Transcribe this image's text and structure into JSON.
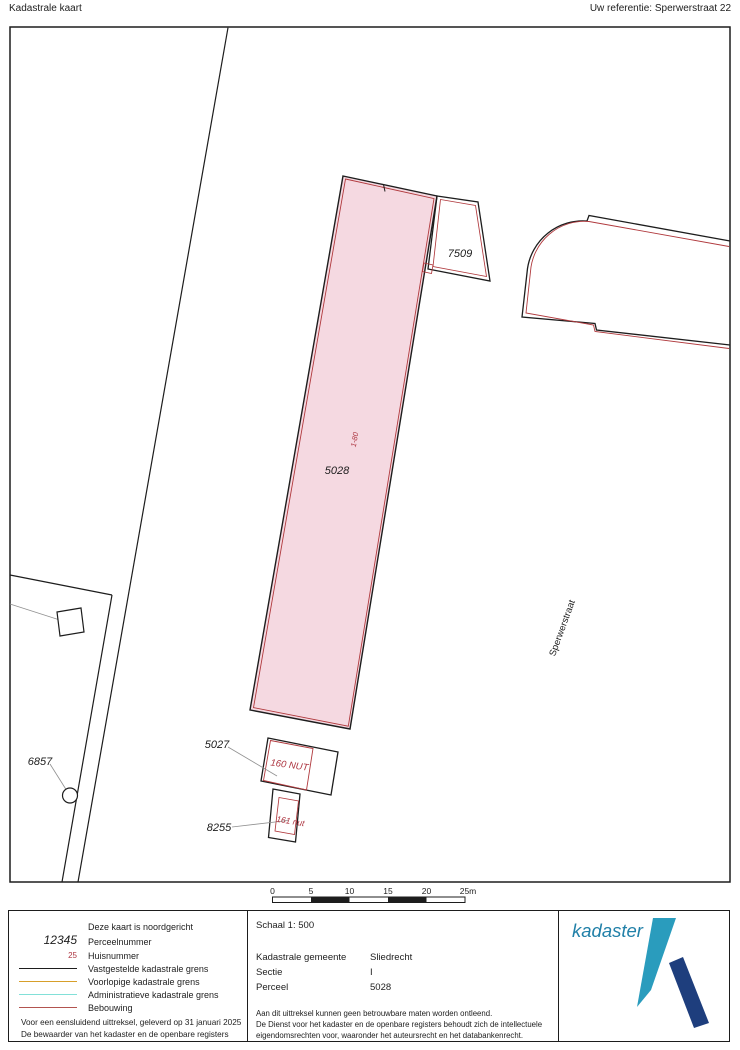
{
  "header": {
    "title": "Kadastrale kaart",
    "reference": "Uw referentie: Sperwerstraat 22"
  },
  "map": {
    "labels": {
      "parcel_7509": "7509",
      "parcel_5028": "5028",
      "parcel_5027": "5027",
      "parcel_8255": "8255",
      "parcel_6857": "6857",
      "house_range": "1-80",
      "house_160": "160 NUT",
      "house_161": "161 nut",
      "street": "Sperwerstraat"
    },
    "scalebar": {
      "ticks": [
        "0",
        "5",
        "10",
        "15",
        "20",
        "25m"
      ]
    }
  },
  "legend": {
    "north_note": "Deze kaart is noordgericht",
    "items": [
      {
        "symbol": "12345",
        "label": "Perceelnummer"
      },
      {
        "symbol": "25",
        "label": "Huisnummer"
      },
      {
        "label": "Vastgestelde kadastrale grens",
        "color": "#1d1d1d"
      },
      {
        "label": "Voorlopige kadastrale grens",
        "color": "#d79f2a"
      },
      {
        "label": "Administratieve kadastrale grens",
        "color": "#82e0d8"
      },
      {
        "label": "Bebouwing",
        "color": "#b2534f"
      }
    ],
    "footer_left": [
      "Voor een eensluidend uittreksel, geleverd op 31 januari 2025",
      "De bewaarder van het kadaster en de openbare registers"
    ],
    "scale_label": "Schaal 1: 500",
    "fields": [
      {
        "label": "Kadastrale gemeente",
        "value": "Sliedrecht"
      },
      {
        "label": "Sectie",
        "value": "I"
      },
      {
        "label": "Perceel",
        "value": "5028"
      }
    ],
    "footer_middle": [
      "Aan dit uittreksel kunnen geen betrouwbare maten worden ontleend.",
      "De Dienst voor het kadaster en de openbare registers behoudt zich de intellectuele",
      "eigendomsrechten voor, waaronder het auteursrecht en het databankenrecht."
    ],
    "logo_text": "kadaster"
  },
  "colors": {
    "parcel_highlight_fill": "#f5d9e1",
    "boundary_black": "#1d1d1d",
    "building_red": "#b0393d",
    "house_number_red": "#ad3540",
    "leader_gray": "#909090",
    "provisional_orange": "#d79f2a",
    "administrative_cyan": "#82e0d8",
    "legend_building_red": "#b2534f",
    "logo_teal": "#2a9cbd",
    "logo_dark_blue": "#1e3e7d",
    "logo_text_blue": "#2180a8"
  }
}
